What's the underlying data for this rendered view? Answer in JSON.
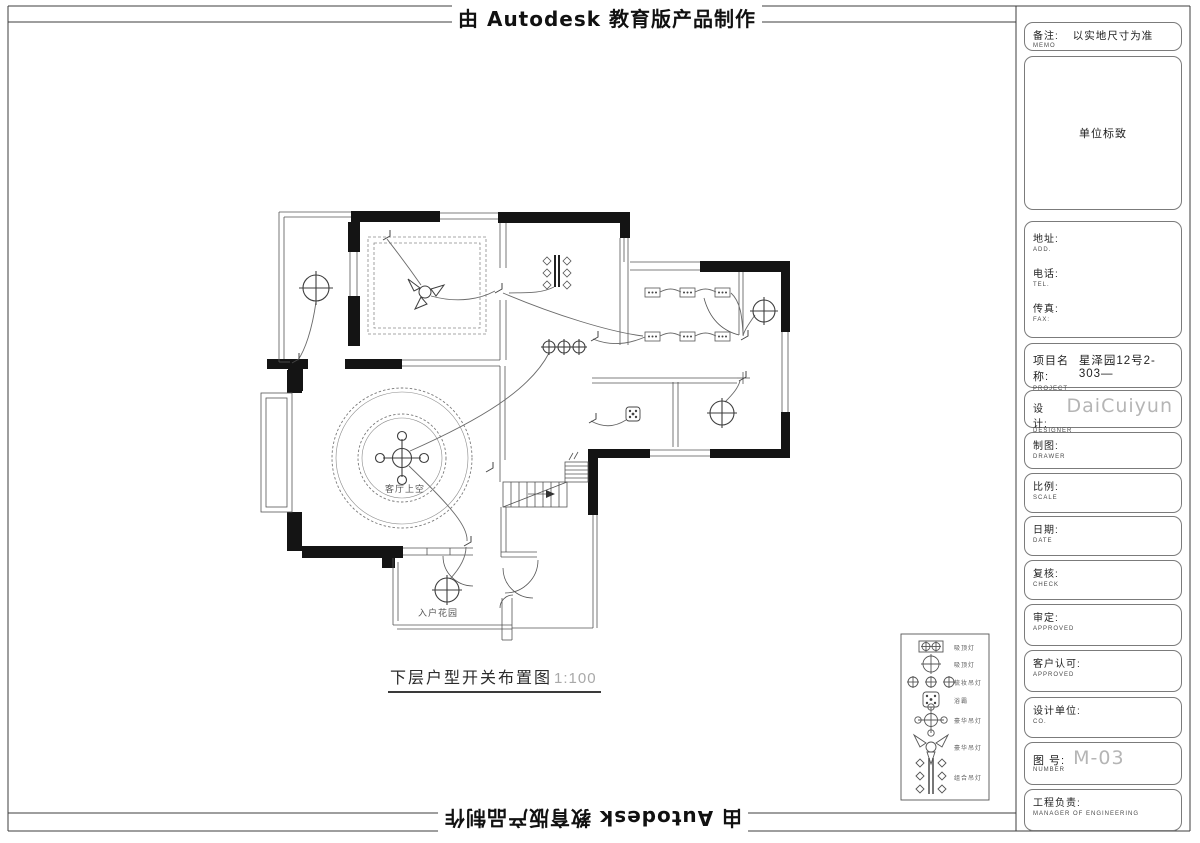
{
  "banner": {
    "top": "由 Autodesk 教育版产品制作",
    "bottom": "由 Autodesk 教育版产品制作"
  },
  "plan": {
    "title": "下层户型开关布置图",
    "scale": "1:100",
    "labels": {
      "living_void": "客厅上空",
      "entry_garden": "入户花园"
    }
  },
  "legend": {
    "items": [
      {
        "symbol": "double-downlight-box-icon",
        "label": "吸顶灯"
      },
      {
        "symbol": "ceiling-lamp-icon",
        "label": "吸顶灯"
      },
      {
        "symbol": "triple-downlight-icon",
        "label": "梳妆吊灯"
      },
      {
        "symbol": "bath-heater-icon",
        "label": "浴霸"
      },
      {
        "symbol": "four-head-chandelier-icon",
        "label": "豪华吊灯"
      },
      {
        "symbol": "three-head-chandelier-icon",
        "label": "豪华吊灯"
      },
      {
        "symbol": "bar-chandelier-icon",
        "label": "组合吊灯"
      }
    ]
  },
  "title_block": {
    "memo": {
      "zh": "备注:",
      "en": "MEMO",
      "value": "以实地尺寸为准"
    },
    "logo": {
      "value": "单位标致"
    },
    "contact": {
      "addr_zh": "地址:",
      "addr_en": "ADD.",
      "tel_zh": "电话:",
      "tel_en": "TEL.",
      "fax_zh": "传真:",
      "fax_en": "FAX:"
    },
    "project": {
      "zh": "项目名称:",
      "en": "PROJECT",
      "value": "星泽园12号2-303—"
    },
    "designer": {
      "zh": "设计:",
      "en": "DESIGNER",
      "value": "DaiCuiyun"
    },
    "drawer": {
      "zh": "制图:",
      "en": "DRAWER"
    },
    "scale": {
      "zh": "比例:",
      "en": "SCALE"
    },
    "date": {
      "zh": "日期:",
      "en": "DATE"
    },
    "check": {
      "zh": "复核:",
      "en": "CHECK"
    },
    "approve": {
      "zh": "审定:",
      "en": "APPROVED"
    },
    "client": {
      "zh": "客户认可:",
      "en": "APPROVED"
    },
    "company": {
      "zh": "设计单位:",
      "en": "CO."
    },
    "number": {
      "zh": "图  号:",
      "en": "NUMBER",
      "value": "M-03"
    },
    "manager": {
      "zh": "工程负责:",
      "en": "MANAGER OF ENGINEERING"
    }
  },
  "colors": {
    "wall": "#141414",
    "line": "#555555",
    "wire": "#6a6a6a",
    "muted": "#b5b5b5"
  }
}
